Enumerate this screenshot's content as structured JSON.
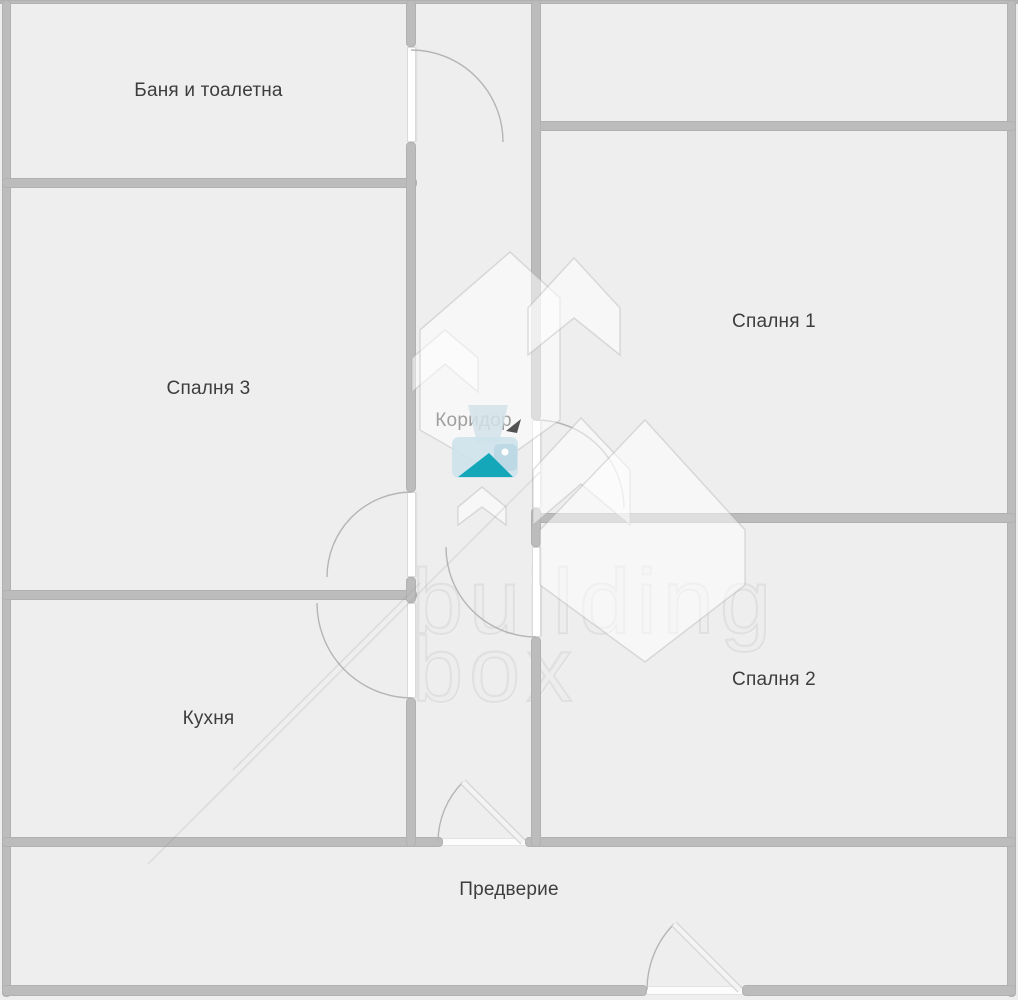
{
  "plan": {
    "rooms": {
      "bathroom": {
        "label": "Баня и тоалетна"
      },
      "bedroom3": {
        "label": "Спалня 3"
      },
      "corridor": {
        "label": "Коридор"
      },
      "bedroom1": {
        "label": "Спалня 1"
      },
      "bedroom2": {
        "label": "Спалня 2"
      },
      "kitchen": {
        "label": "Кухня"
      },
      "hall": {
        "label": "Предверие"
      }
    },
    "watermark": {
      "line1": "building",
      "line2": "box",
      "logo_name": "building-box-logo"
    },
    "colors": {
      "wall": "#bcbcbc",
      "room_fill": "#eeeeee",
      "accent_teal": "#14a7ba",
      "logo_light_blue": "#d2e4eb",
      "label_text": "#3d3d3d",
      "watermark_outline": "#e0e0e0"
    }
  }
}
